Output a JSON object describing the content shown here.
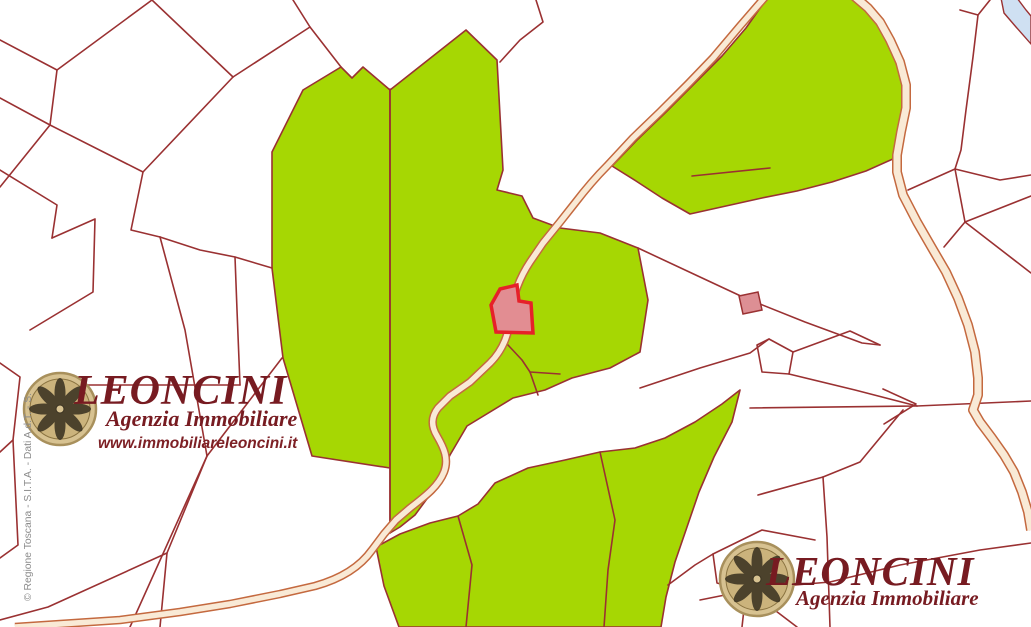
{
  "watermark_primary": {
    "brand": "LEONCINI",
    "tagline": "Agenzia Immobiliare",
    "website": "www.immobiliareleoncini.it"
  },
  "watermark_secondary": {
    "brand": "LEONCINI",
    "tagline": "Agenzia Immobiliare"
  },
  "attribution": {
    "text": "© Regione Toscana - S.I.T.A. - Dati A.d.T. - S."
  },
  "colors": {
    "background": "#ffffff",
    "parcel_outline": "#9a3132",
    "vegetation_green": "#a6d703",
    "road_fill": "#f9ead6",
    "road_edge": "#c4693f",
    "highlight_parcel_fill": "#e28d92",
    "highlight_parcel_border": "#e62129",
    "secondary_highlight_fill": "#dd8f94",
    "water": "#cfe0f2",
    "brand_maroon": "#771b21",
    "attribution_gray": "#8c8c8c",
    "emblem_gold": "#d7c291"
  }
}
